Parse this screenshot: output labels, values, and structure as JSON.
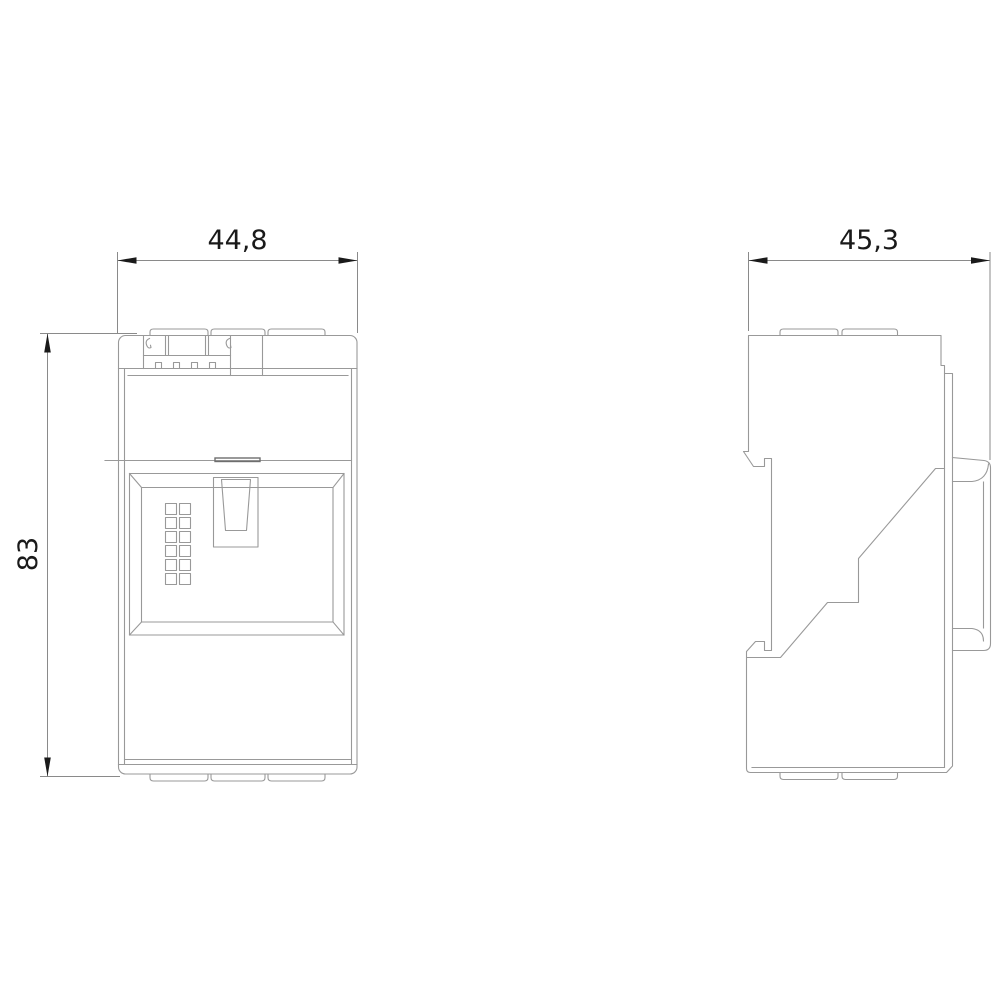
{
  "page": {
    "background": "#ffffff"
  },
  "drawing": {
    "type": "technical-dimension-drawing",
    "part_line_color": "#999999",
    "dimension_line_color": "#8a8a8a",
    "dimension_text_color": "#1a1a1a",
    "views": {
      "front_view": "module front with socket frame, latch slot and 2x6 contact grid",
      "side_view": "module side profile with DIN-rail clips and right terminal block"
    },
    "dimensions": {
      "front_width_label": "44,8",
      "front_height_label": "83",
      "side_depth_label": "45,3"
    }
  }
}
